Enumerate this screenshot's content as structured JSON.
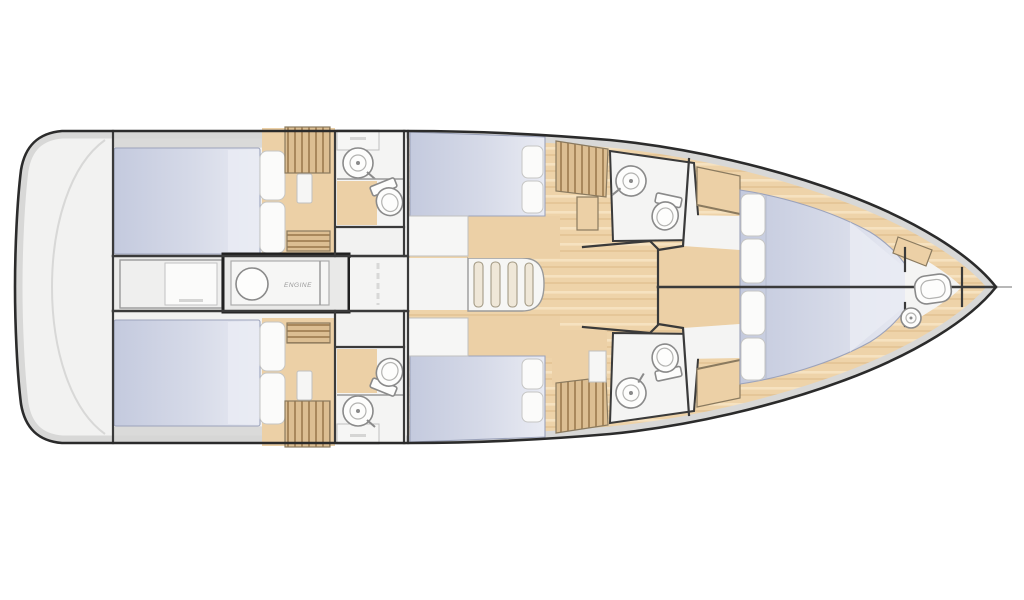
{
  "meta": {
    "title": "Sailing yacht interior deck plan, top-down view, bow pointing right",
    "orientation": "bow-right"
  },
  "labels": {
    "engine": "ENGINE"
  },
  "colors": {
    "page_bg": "#ffffff",
    "hull_fill": "#f2f2f1",
    "hull_rim": "#d8d8d7",
    "hull_outline": "#2b2b2b",
    "wall": "#3a3a3a",
    "wall_light": "#9a9a9a",
    "wood_floor": "#eed3a9",
    "wood_grain_light": "#f7e6c6",
    "wood_grain_dark": "#e2c191",
    "slat_wood": "#dcbe92",
    "slat_line": "#a07f52",
    "tan_furniture": "#ecd0a6",
    "tan_outline": "#8a7a5f",
    "bed_dark": "#c4cade",
    "bed_mid": "#d6dae8",
    "bed_light": "#e9ebf3",
    "bed_stroke": "#9ca3bb",
    "pillow": "#fbfbfa",
    "pillow_stroke": "#c6c6c4",
    "bath_floor": "#f4f4f3",
    "fixture_fill": "#fdfdfc",
    "fixture_stroke": "#8a8a8a",
    "engine_border": "#1f1f1f",
    "panel_fill": "#efefee",
    "corridor": "#ececeb",
    "shadow_band": "#d6d6d5",
    "step_tread": "#efe7d8",
    "step_stroke": "#a39a85"
  },
  "plan": {
    "rooms": [
      {
        "id": "stern-platform",
        "name": "stern transom platform"
      },
      {
        "id": "aft-cabin-port",
        "name": "aft double cabin (port)"
      },
      {
        "id": "aft-cabin-starboard",
        "name": "aft double cabin (starboard)"
      },
      {
        "id": "aft-head-port",
        "name": "aft bathroom (port)"
      },
      {
        "id": "aft-head-starboard",
        "name": "aft bathroom (starboard)"
      },
      {
        "id": "engine-room",
        "name": "engine room"
      },
      {
        "id": "companionway",
        "name": "companionway stairs"
      },
      {
        "id": "saloon",
        "name": "saloon with wood floor"
      },
      {
        "id": "mid-cabin-port",
        "name": "midship double cabin (port)"
      },
      {
        "id": "mid-cabin-starboard",
        "name": "midship double cabin (starboard)"
      },
      {
        "id": "mid-head-port",
        "name": "midship bathroom (port)"
      },
      {
        "id": "mid-head-starboard",
        "name": "midship bathroom (starboard)"
      },
      {
        "id": "fore-cabin-port",
        "name": "forward V-berth cabin (port)"
      },
      {
        "id": "fore-cabin-starboard",
        "name": "forward V-berth cabin (starboard)"
      },
      {
        "id": "bow-head",
        "name": "bow bathroom"
      }
    ],
    "fixture_counts": {
      "double_berths": 6,
      "toilets": 5,
      "sinks": 5,
      "wardrobes": 4,
      "companionway_stairs": 1,
      "engines": 1
    }
  }
}
